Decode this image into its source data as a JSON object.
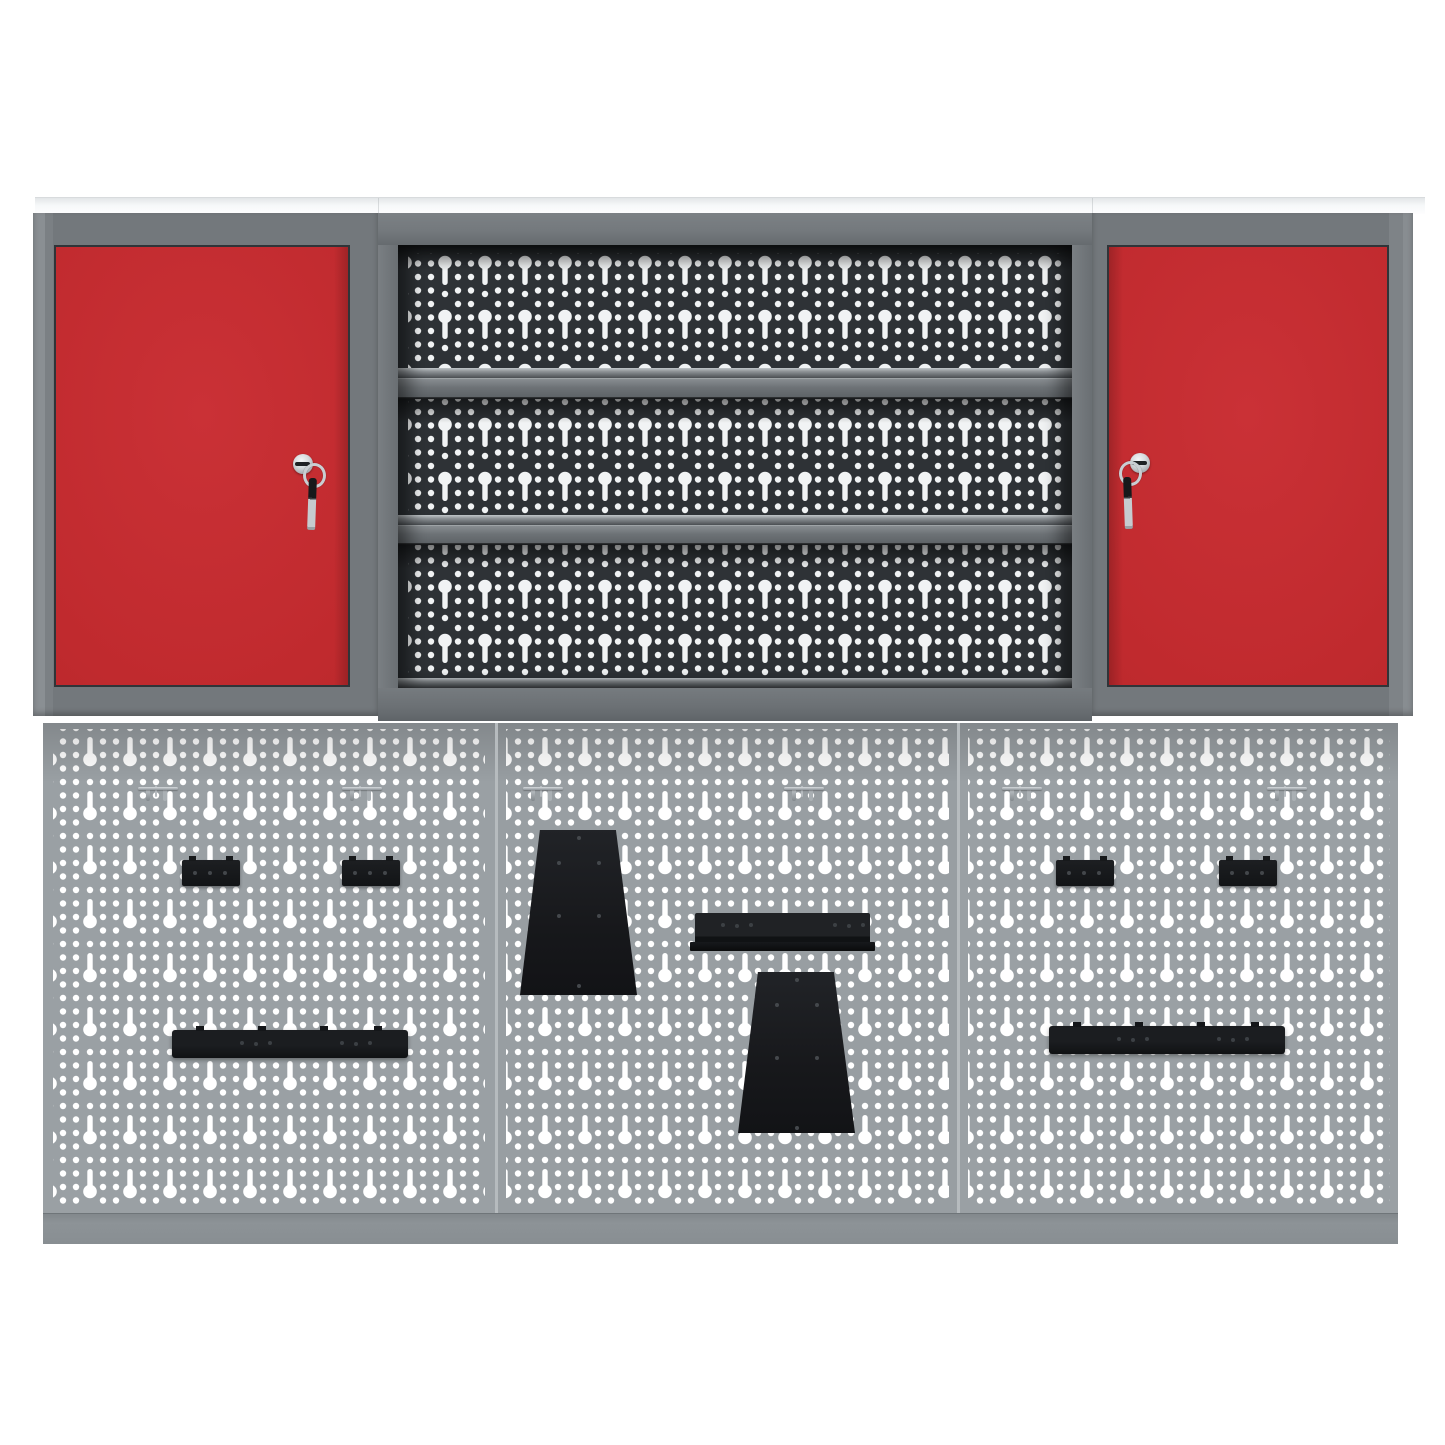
{
  "scene": {
    "kind": "product-photo",
    "background_color": "#ffffff",
    "subject": "Workshop wall storage set: two red lockable wall cabinets, a central open shelf unit with perforated back panel, and a three-panel perforated tool wall with black mounting brackets and steel hooks"
  },
  "palette": {
    "door_red": "#c02a2e",
    "frame_gray": "#73787c",
    "upper_pegboard_dark": "#2b2f33",
    "lower_pegboard_gray": "#9aa0a4",
    "hole_white": "#ffffff",
    "accessory_black": "#17191b",
    "chrome_silver": "#c9ced2",
    "top_panel_white": "#f6f8f9",
    "bottom_rail_gray": "#8d9397"
  },
  "unit": {
    "top_panel": {
      "label": "top cover panel"
    },
    "left_cabinet": {
      "label": "left wall cabinet with red door",
      "lock": "cylinder lock with hanging key"
    },
    "center_shelf_unit": {
      "label": "open shelf unit",
      "shelf_count": 3,
      "back": "perforated euro-hole panel"
    },
    "right_cabinet": {
      "label": "right wall cabinet with red door",
      "lock": "cylinder lock with hanging key"
    },
    "lower_wall": {
      "label": "perforated tool-wall",
      "panel_count": 3
    }
  },
  "pegboard": {
    "accessories": [
      {
        "type": "hook",
        "name": "wall-hook-1",
        "x": 93,
        "y": 62,
        "w": 44,
        "h": 20
      },
      {
        "type": "hook",
        "name": "wall-hook-2",
        "x": 297,
        "y": 62,
        "w": 44,
        "h": 20
      },
      {
        "type": "hook",
        "name": "wall-hook-3",
        "x": 478,
        "y": 62,
        "w": 44,
        "h": 20
      },
      {
        "type": "hook",
        "name": "wall-hook-4",
        "x": 739,
        "y": 62,
        "w": 44,
        "h": 20
      },
      {
        "type": "hook",
        "name": "wall-hook-5",
        "x": 957,
        "y": 62,
        "w": 44,
        "h": 20
      },
      {
        "type": "hook",
        "name": "wall-hook-6",
        "x": 1222,
        "y": 62,
        "w": 44,
        "h": 20
      },
      {
        "type": "bracket-small",
        "name": "mount-bracket-1",
        "x": 139,
        "y": 137,
        "w": 58,
        "h": 26
      },
      {
        "type": "bracket-small",
        "name": "mount-bracket-2",
        "x": 299,
        "y": 137,
        "w": 58,
        "h": 26
      },
      {
        "type": "bracket-small",
        "name": "mount-bracket-3",
        "x": 1013,
        "y": 137,
        "w": 58,
        "h": 26
      },
      {
        "type": "bracket-small",
        "name": "mount-bracket-4",
        "x": 1176,
        "y": 137,
        "w": 58,
        "h": 26
      },
      {
        "type": "trapezoid",
        "name": "trapezoid-plate-1",
        "x": 477,
        "y": 107,
        "w": 117,
        "h": 165
      },
      {
        "type": "rail",
        "name": "tool-rail",
        "x": 652,
        "y": 190,
        "w": 175,
        "h": 38
      },
      {
        "type": "trapezoid",
        "name": "trapezoid-plate-2",
        "x": 695,
        "y": 249,
        "w": 117,
        "h": 161
      },
      {
        "type": "bar-long",
        "name": "long-bracket-bar-1",
        "x": 129,
        "y": 307,
        "w": 236,
        "h": 28
      },
      {
        "type": "bar-long",
        "name": "long-bracket-bar-2",
        "x": 1006,
        "y": 303,
        "w": 236,
        "h": 28
      }
    ]
  }
}
